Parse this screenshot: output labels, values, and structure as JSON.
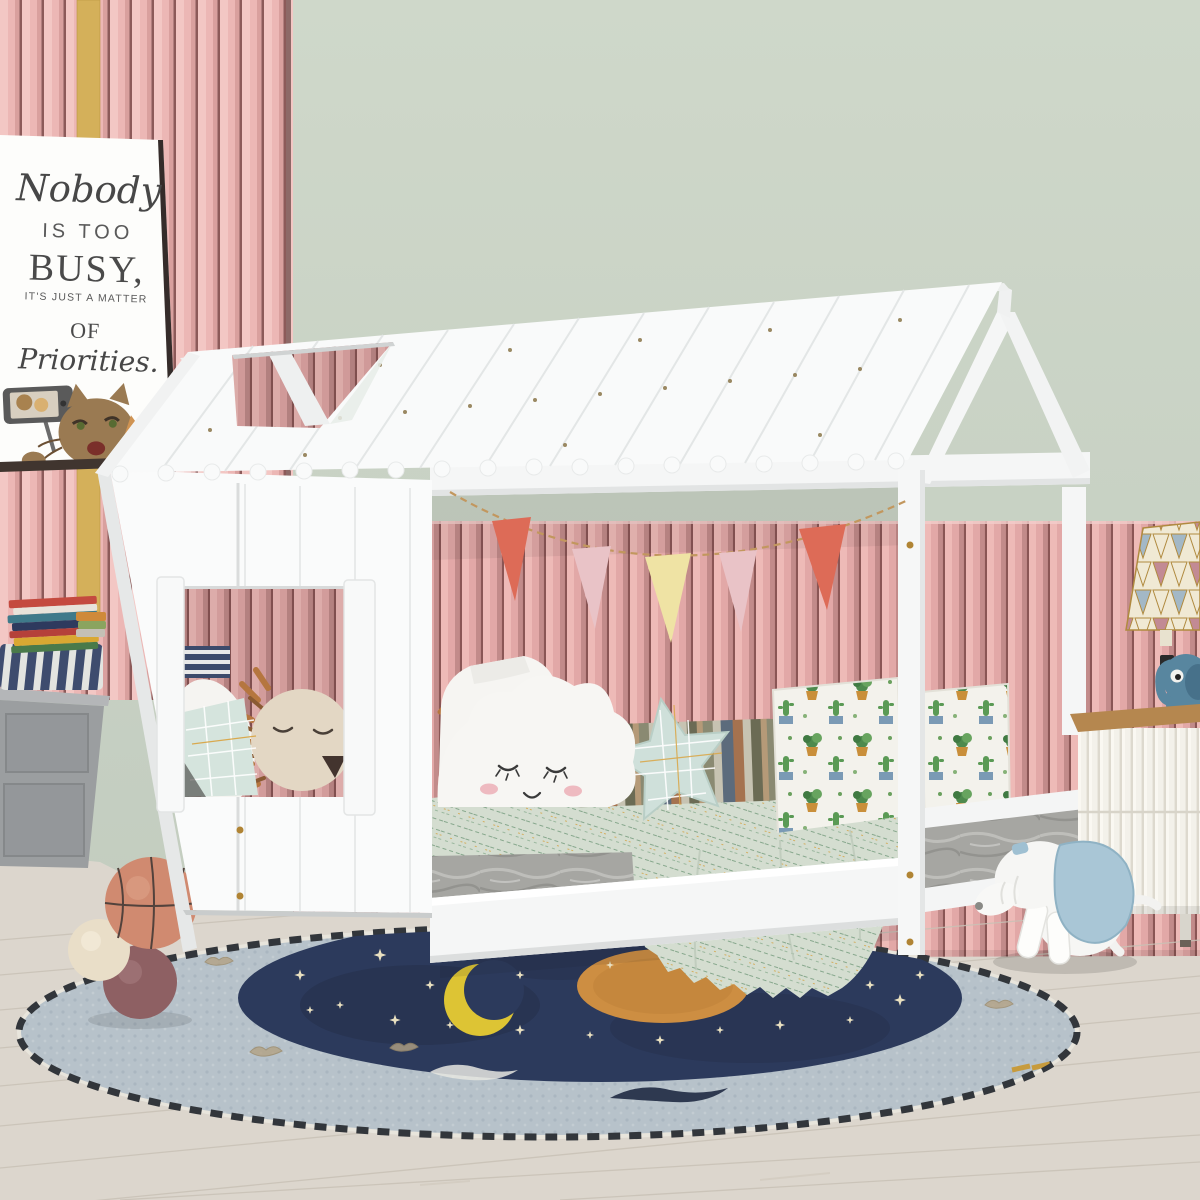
{
  "scene": {
    "description": "Kids bedroom with white house-frame daybed, pink slatted walls, sage green wall, bunting, night-sky round rug"
  },
  "poster": {
    "line1": "Nobody",
    "line2": "IS TOO",
    "line3": "BUSY,",
    "line4": "IT'S JUST A MATTER",
    "line5": "OF",
    "line6": "Priorities."
  },
  "colors": {
    "wall_green": "#c9d3c5",
    "wall_pink_left": "#ecb7b5",
    "wall_pink_right": "#e2a8a7",
    "slat_gap": "#8c5a59",
    "gold_trim": "#d4b05a",
    "house_white": "#fafbfb",
    "roof_white": "#f9fafa",
    "beam_white": "#f5f6f6",
    "pennant_coral": "#dd6b57",
    "pennant_pink": "#e9c3c7",
    "pennant_yellow": "#efe3a4",
    "string_gold": "#c2975e",
    "mattress_gray": "#a6a6a2",
    "blanket_sage": "#d4ddd0",
    "blanket_line_green": "#86a78c",
    "blanket_accent_gold": "#d4a64c",
    "star_pillow_mint": "#cfe0da",
    "plant_pillow_white": "#f3f2ec",
    "plant_green": "#4e8a4e",
    "lion_tan": "#e3d7c4",
    "lion_mane_rust": "#b5763f",
    "bench_gray": "#9b9ea0",
    "cushion_navy": "#3e4c6e",
    "basketball_orange": "#d08a70",
    "ball_cream": "#e9dec8",
    "ball_mauve": "#8e6063",
    "rug_ring_blue": "#b7c2ca",
    "rug_navy": "#2c3a5c",
    "rug_moon_yellow": "#ddc434",
    "rug_sun_orange": "#cd8e42",
    "rug_star_cream": "#e9e0c0",
    "floor_wood": "#dcd6cd",
    "nightstand_white": "#f3f1ea",
    "nightstand_wood_top": "#b5874f",
    "lamp_cream": "#f0e9d4",
    "lamp_pink": "#c28a94",
    "lamp_blue": "#a3b8c6",
    "elephant_blue": "#58869f",
    "dog_white": "#f4f4f2",
    "dog_ear_blue": "#a9c6d6"
  }
}
